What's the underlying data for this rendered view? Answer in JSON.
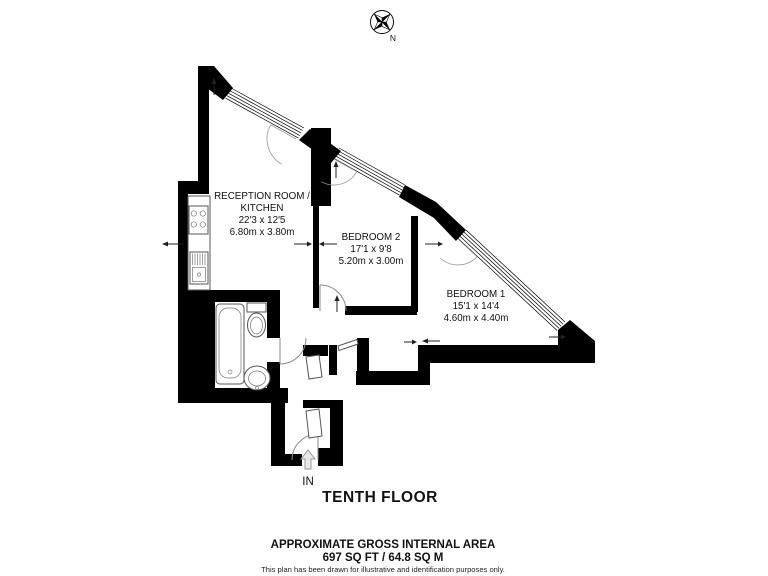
{
  "compass": {
    "north_label": "N"
  },
  "rooms": {
    "reception": {
      "name_line1": "RECEPTION ROOM /",
      "name_line2": "KITCHEN",
      "size_imperial": "22'3 x 12'5",
      "size_metric": "6.80m x 3.80m"
    },
    "bedroom2": {
      "name": "BEDROOM 2",
      "size_imperial": "17'1 x 9'8",
      "size_metric": "5.20m x 3.00m"
    },
    "bedroom1": {
      "name": "BEDROOM 1",
      "size_imperial": "15'1 x 14'4",
      "size_metric": "4.60m x 4.40m"
    }
  },
  "entrance": {
    "label": "IN"
  },
  "floor": {
    "title": "TENTH FLOOR"
  },
  "footer": {
    "area_heading": "APPROXIMATE GROSS INTERNAL AREA",
    "area_value": "697 SQ FT / 64.8 SQ M",
    "disclaimer": "This plan has been drawn for illustrative and identification purposes only."
  },
  "colors": {
    "wall": "#000000",
    "door_arc": "#8a8a8a",
    "fixture": "#555555",
    "text": "#111111"
  }
}
